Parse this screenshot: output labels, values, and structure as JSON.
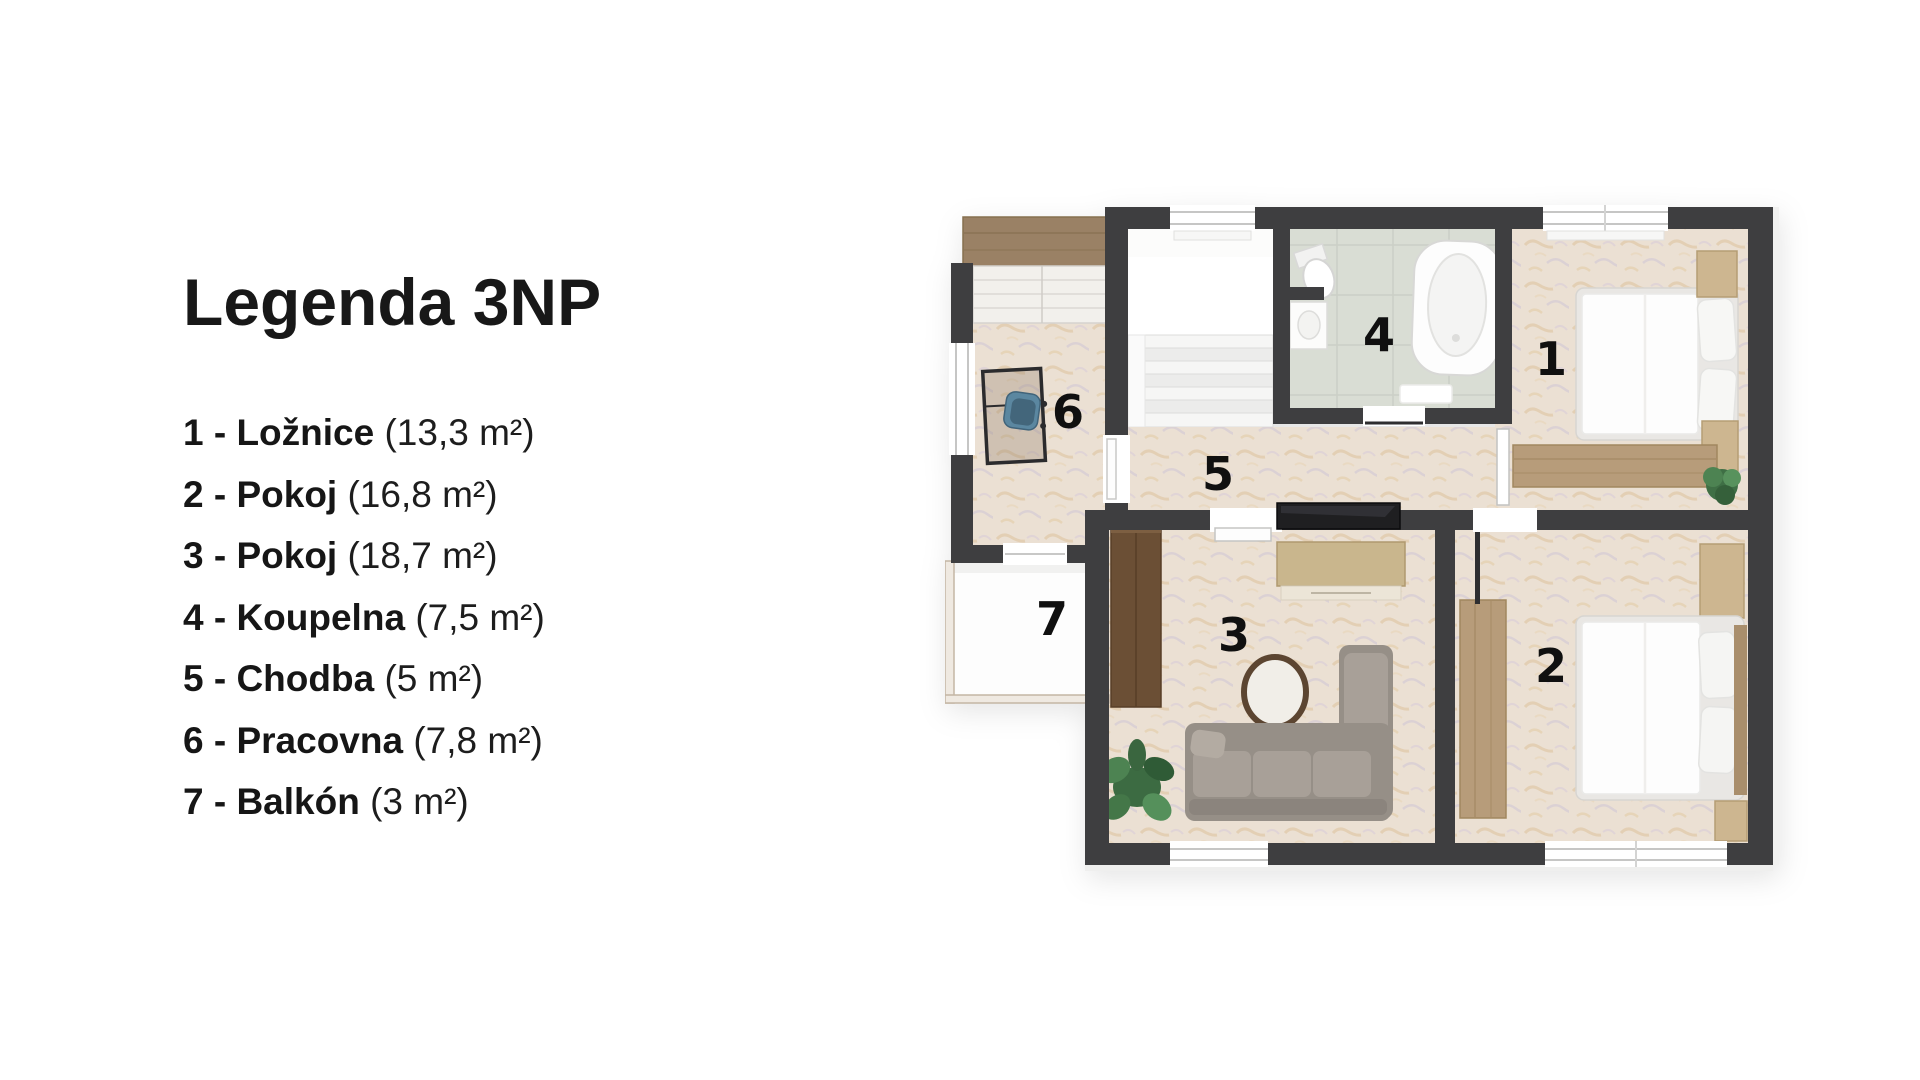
{
  "page": {
    "background": "#ffffff"
  },
  "legend": {
    "title": "Legenda 3NP",
    "items": [
      {
        "label": "1 - Ložnice",
        "area": "(13,3 m²)"
      },
      {
        "label": "2 - Pokoj",
        "area": "(16,8 m²)"
      },
      {
        "label": "3 - Pokoj",
        "area": "(18,7 m²)"
      },
      {
        "label": "4 - Koupelna",
        "area": "(7,5 m²)"
      },
      {
        "label": "5 - Chodba",
        "area": "(5 m²)"
      },
      {
        "label": "6 - Pracovna",
        "area": "(7,8 m²)"
      },
      {
        "label": "7 - Balkón",
        "area": "(3 m²)"
      }
    ]
  },
  "floorplan": {
    "rooms": [
      {
        "number": "1",
        "name": "Ložnice"
      },
      {
        "number": "2",
        "name": "Pokoj"
      },
      {
        "number": "3",
        "name": "Pokoj"
      },
      {
        "number": "4",
        "name": "Koupelna"
      },
      {
        "number": "5",
        "name": "Chodba"
      },
      {
        "number": "6",
        "name": "Pracovna"
      },
      {
        "number": "7",
        "name": "Balkón"
      }
    ],
    "colors": {
      "wall": "#3e3e40",
      "floor_beige": "#ebe0d3",
      "floor_tile": "#d9ddd4",
      "wood_dark": "#6b4f35",
      "wood_mid": "#b79c7a",
      "wood_tan": "#cdb690",
      "sofa": "#968f87",
      "plant": "#47784d",
      "chair": "#5b87a0",
      "tv": "#1f1f21"
    }
  }
}
